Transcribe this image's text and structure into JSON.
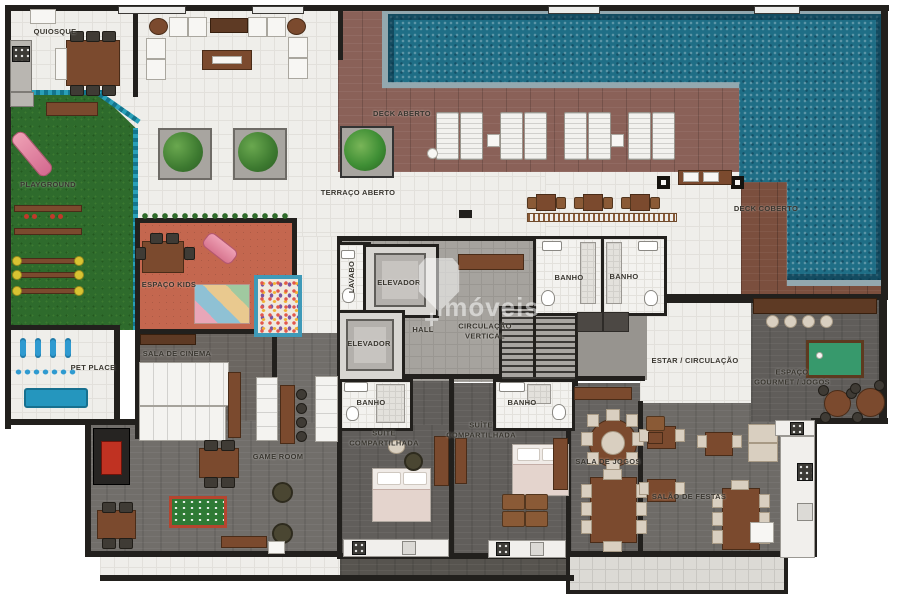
{
  "watermark": {
    "plus": "+",
    "text": "imóveis"
  },
  "rooms": {
    "quiosque": {
      "label": "QUIOSQUE",
      "x": 55,
      "y": 32
    },
    "playground": {
      "label": "PLAYGROUND",
      "x": 48,
      "y": 185
    },
    "pet_place": {
      "label": "PET PLACE",
      "x": 93,
      "y": 368
    },
    "espaco_kids": {
      "label": "ESPAÇO KIDS",
      "x": 169,
      "y": 285
    },
    "sala_de_cinema": {
      "label": "SALA DE CINEMA",
      "x": 177,
      "y": 354
    },
    "game_room": {
      "label": "GAME ROOM",
      "x": 278,
      "y": 457
    },
    "terraco_aberto": {
      "label": "TERRAÇO ABERTO",
      "x": 358,
      "y": 193
    },
    "deck_aberto": {
      "label": "DECK ABERTO",
      "x": 402,
      "y": 114
    },
    "deck_coberto": {
      "label": "DECK COBERTO",
      "x": 766,
      "y": 209
    },
    "lavabo": {
      "label": "LAVABO",
      "x": 352,
      "y": 277,
      "rot": -90
    },
    "elevador_1": {
      "label": "ELEVADOR",
      "x": 399,
      "y": 283
    },
    "elevador_2": {
      "label": "ELEVADOR",
      "x": 369,
      "y": 344
    },
    "hall": {
      "label": "HALL",
      "x": 423,
      "y": 330
    },
    "circulacao_vertical": {
      "label": "CIRCULAÇÃO\nVERTICAL",
      "x": 485,
      "y": 331
    },
    "banho_central_1": {
      "label": "BANHO",
      "x": 569,
      "y": 278
    },
    "banho_central_2": {
      "label": "BANHO",
      "x": 624,
      "y": 277
    },
    "estar_circulacao": {
      "label": "ESTAR / CIRCULAÇÃO",
      "x": 695,
      "y": 361
    },
    "espaco_gourmet_jogos": {
      "label": "ESPAÇO\nGOURMET / JOGOS",
      "x": 792,
      "y": 377
    },
    "suite_compartilhada_1": {
      "label": "SUÍTE\nCOMPARTILHADA",
      "x": 384,
      "y": 438
    },
    "banho_suite_1": {
      "label": "BANHO",
      "x": 371,
      "y": 403
    },
    "suite_compartilhada_2": {
      "label": "SUÍTE\nCOMPARTILHADA",
      "x": 481,
      "y": 430
    },
    "banho_suite_2": {
      "label": "BANHO",
      "x": 522,
      "y": 403
    },
    "sala_de_jogos": {
      "label": "SALA DE JOGOS",
      "x": 608,
      "y": 462
    },
    "salao_de_festas": {
      "label": "SALÃO DE FESTAS",
      "x": 689,
      "y": 497
    }
  }
}
